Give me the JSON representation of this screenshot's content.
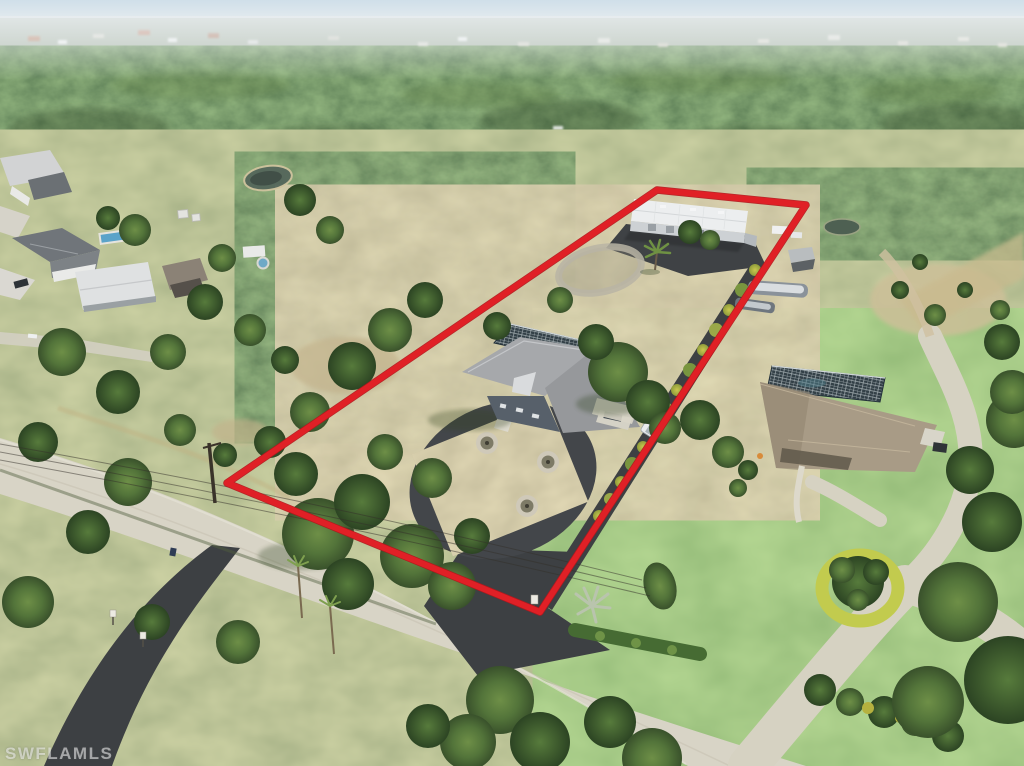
{
  "watermark": {
    "text": "SWFLAMLS"
  },
  "boundary": {
    "color": "#e02026",
    "underlay_color": "#b3161c",
    "stroke_width": "6"
  },
  "palette": {
    "sky_top": "#cfdfe9",
    "sky_bottom": "#eaeef0",
    "haze_band": "#b9c3b6",
    "forest_dark": "#3a5230",
    "scrub_green": "#8c9a62",
    "lawn_green": "#72a14c",
    "dry_grass": "#b3a878",
    "asphalt": "#3d4043",
    "concrete_road": "#d8d4c6",
    "warehouse_roof": "#eceeef",
    "house_roof": "#a6a8ab",
    "neighbor_roof": "#a89b86",
    "screen_cage": "#334047",
    "pool_water": "#5ba3c9",
    "white_vehicle": "#e9ebed"
  }
}
